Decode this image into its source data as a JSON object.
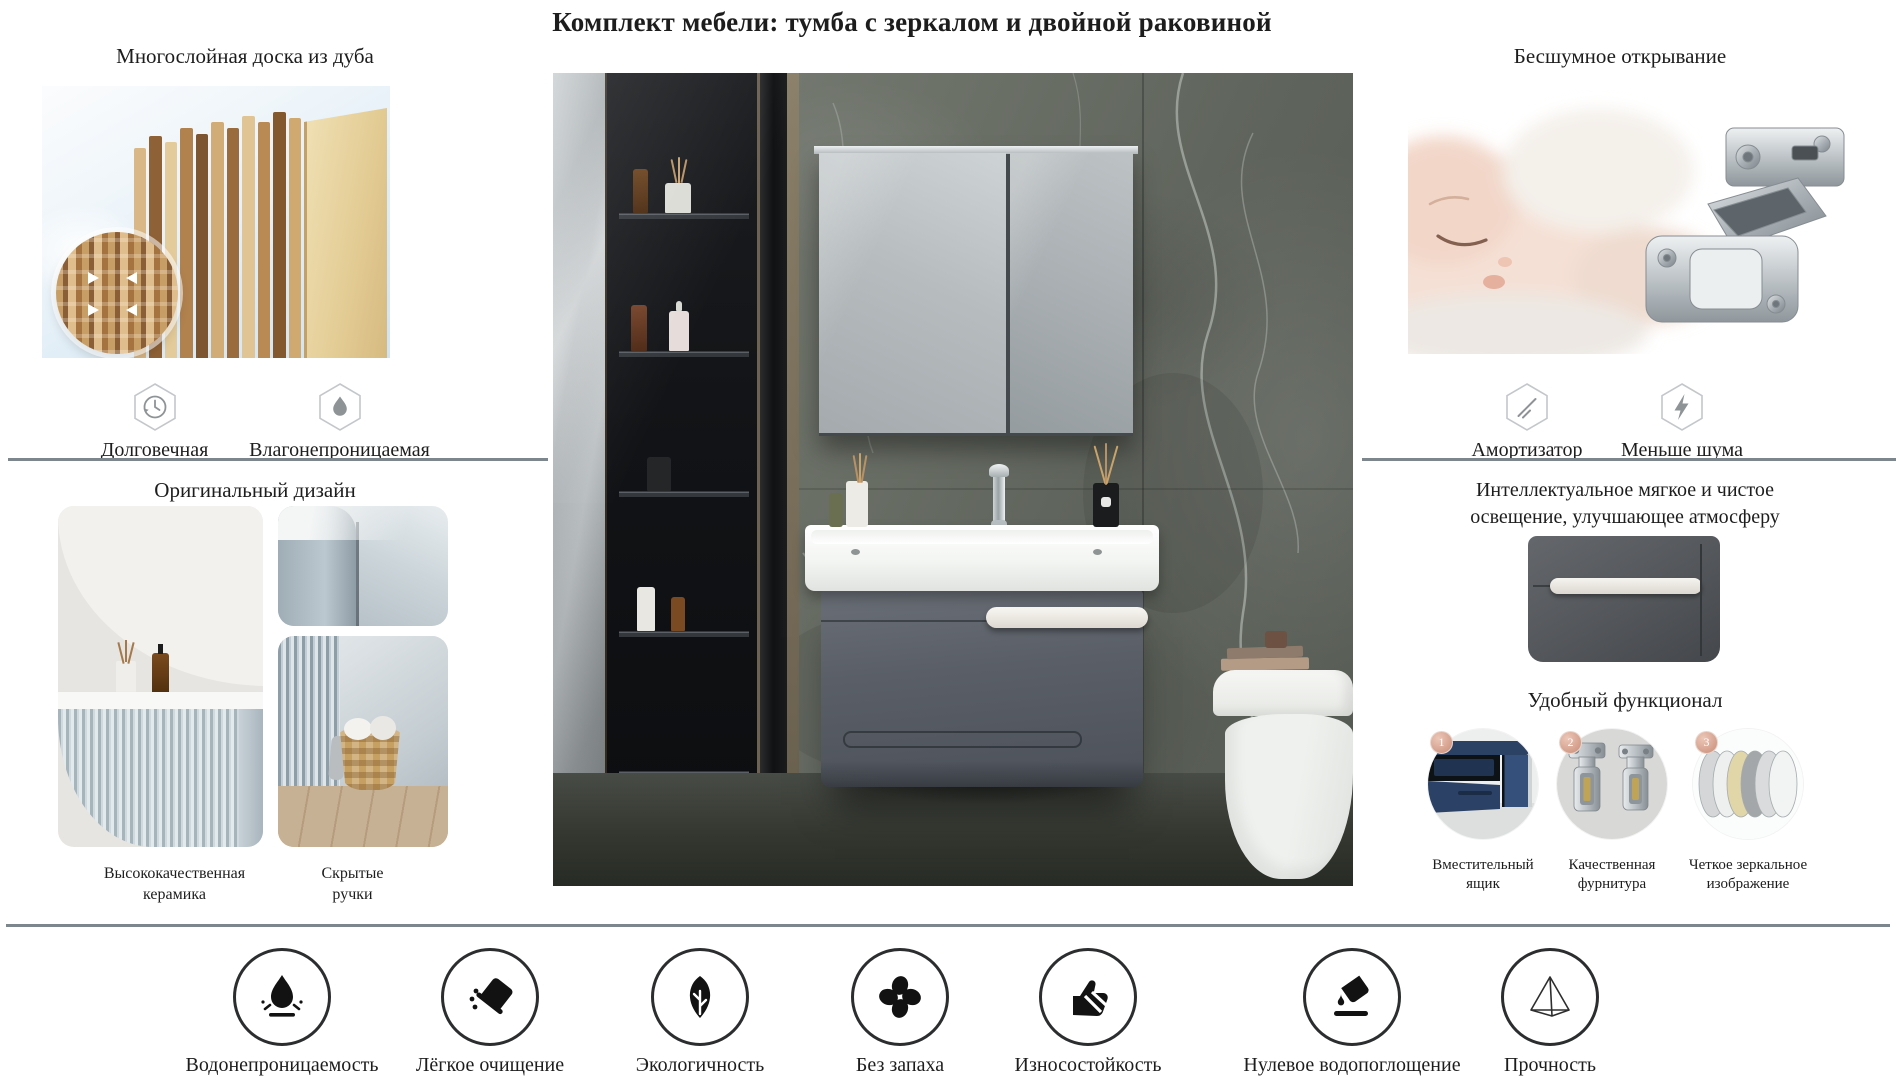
{
  "title": "Комплект мебели: тумба с зеркалом и двойной раковиной",
  "left": {
    "oak": {
      "heading": "Многослойная доска из дуба",
      "features": [
        {
          "icon": "clock-icon",
          "label": "Долговечная"
        },
        {
          "icon": "waterdrop-icon",
          "label": "Влагонепроницаемая"
        }
      ]
    },
    "design": {
      "heading": "Оригинальный дизайн",
      "captions": [
        "Высококачественная керамика",
        "Скрытые ручки"
      ]
    }
  },
  "right": {
    "opening": {
      "heading": "Бесшумное открывание",
      "features": [
        {
          "icon": "damper-icon",
          "label": "Амортизатор"
        },
        {
          "icon": "lightning-icon",
          "label": "Меньше шума"
        }
      ]
    },
    "lighting": {
      "lines": [
        "Интеллектуальное мягкое и чистое",
        "освещение, улучшающее атмосферу"
      ]
    },
    "functional": {
      "heading": "Удобный функционал",
      "items": [
        {
          "num": "1",
          "caption": "Вместительный ящик"
        },
        {
          "num": "2",
          "caption": "Качественная фурнитура"
        },
        {
          "num": "3",
          "caption": "Четкое зеркальное изображение"
        }
      ]
    }
  },
  "bottom": {
    "features": [
      {
        "icon": "waterproof-icon",
        "label": "Водонепроницаемость"
      },
      {
        "icon": "easy-clean-icon",
        "label": "Лёгкое очищение"
      },
      {
        "icon": "eco-icon",
        "label": "Экологичность"
      },
      {
        "icon": "odorless-icon",
        "label": "Без запаха"
      },
      {
        "icon": "wear-resistance-icon",
        "label": "Износостойкость"
      },
      {
        "icon": "zero-water-absorption-icon",
        "label": "Нулевое водопоглощение"
      },
      {
        "icon": "strength-icon",
        "label": "Прочность"
      }
    ]
  },
  "colors": {
    "divider": "#7d868c",
    "text": "#1d1d1d",
    "badge": "#cf9483"
  }
}
